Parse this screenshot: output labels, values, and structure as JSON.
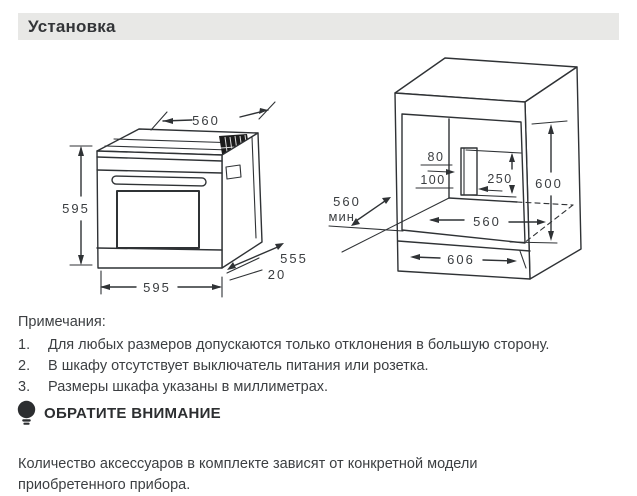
{
  "header": {
    "title": "Установка"
  },
  "oven_diagram": {
    "top_width": "560",
    "height": "595",
    "bottom_width": "595",
    "depth": "555",
    "back_ledge": "20"
  },
  "cabinet_diagram": {
    "cutout_width": "80",
    "cutout_offset": "100",
    "cutout_height": "250",
    "niche_height": "600",
    "niche_width": "560",
    "min_depth": "560",
    "min_depth_unit": "мин.",
    "outer_width": "606"
  },
  "notes": {
    "heading": "Примечания:",
    "items": [
      {
        "num": "1.",
        "text": "Для любых размеров допускаются только отклонения в большую сторону."
      },
      {
        "num": "2.",
        "text": "В шкафу отсутствует выключатель питания или розетка."
      },
      {
        "num": "3.",
        "text": "Размеры шкафа указаны в миллиметрах."
      }
    ]
  },
  "attention": {
    "heading": "ОБРАТИТЕ ВНИМАНИЕ",
    "body": "Количество аксессуаров в комплекте зависят от конкретной модели приобретенного прибора."
  }
}
